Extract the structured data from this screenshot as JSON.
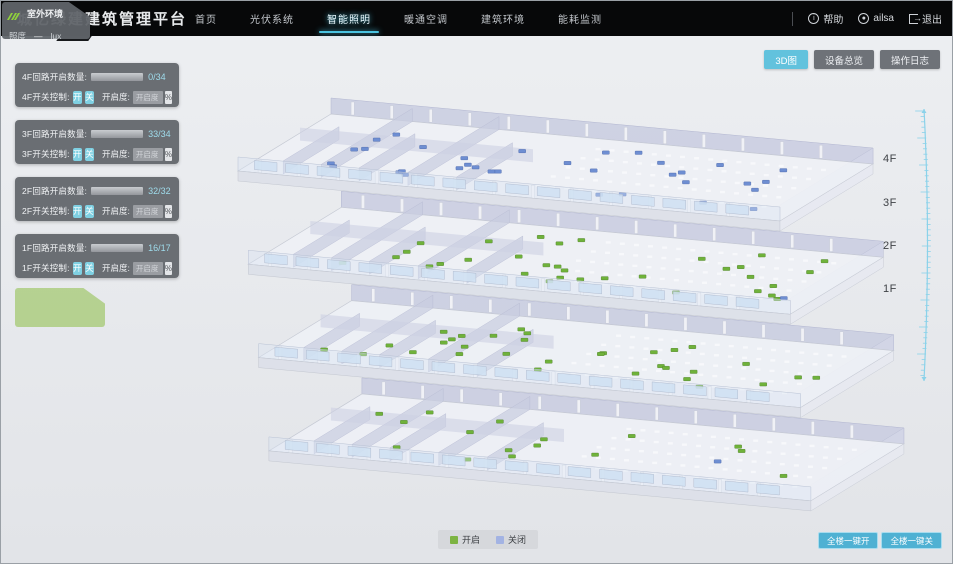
{
  "header": {
    "title": "城亿绿建建筑管理平台",
    "nav": [
      {
        "label": "首页"
      },
      {
        "label": "光伏系统"
      },
      {
        "label": "智能照明"
      },
      {
        "label": "暖通空调"
      },
      {
        "label": "建筑环境"
      },
      {
        "label": "能耗监测"
      }
    ],
    "right": {
      "help": "帮助",
      "user": "ailsa",
      "logout": "退出"
    }
  },
  "floor_panels": [
    {
      "count_label": "4F回路开启数量:",
      "count_text": "0/34",
      "on": 0,
      "total": 34,
      "switch_label": "4F开关控制:",
      "on_btn": "开",
      "off_btn": "关",
      "dim_label": "开启度:",
      "dim_placeholder": "开启度",
      "percent": "%"
    },
    {
      "count_label": "3F回路开启数量:",
      "count_text": "33/34",
      "on": 33,
      "total": 34,
      "switch_label": "3F开关控制:",
      "on_btn": "开",
      "off_btn": "关",
      "dim_label": "开启度:",
      "dim_placeholder": "开启度",
      "percent": "%"
    },
    {
      "count_label": "2F回路开启数量:",
      "count_text": "32/32",
      "on": 32,
      "total": 32,
      "switch_label": "2F开关控制:",
      "on_btn": "开",
      "off_btn": "关",
      "dim_label": "开启度:",
      "dim_placeholder": "开启度",
      "percent": "%"
    },
    {
      "count_label": "1F回路开启数量:",
      "count_text": "16/17",
      "on": 16,
      "total": 17,
      "switch_label": "1F开关控制:",
      "on_btn": "开",
      "off_btn": "关",
      "dim_label": "开启度:",
      "dim_placeholder": "开启度",
      "percent": "%"
    }
  ],
  "outdoor": {
    "title": "室外环境",
    "metric": "照度",
    "value": "—",
    "unit": "lux"
  },
  "view_buttons": [
    {
      "label": "3D图",
      "active": true
    },
    {
      "label": "设备总览",
      "active": false
    },
    {
      "label": "操作日志",
      "active": false
    }
  ],
  "floor_labels": [
    "4F",
    "3F",
    "2F",
    "1F"
  ],
  "legend": [
    {
      "label": "开启",
      "color": "#7cb342"
    },
    {
      "label": "关闭",
      "color": "#a3b3e3"
    }
  ],
  "bulk_buttons": [
    {
      "label": "全楼一键开"
    },
    {
      "label": "全楼一键关"
    }
  ],
  "building": {
    "floors": [
      {
        "name": "4F",
        "lights_on": 0,
        "lights_off": 34
      },
      {
        "name": "3F",
        "lights_on": 33,
        "lights_off": 1
      },
      {
        "name": "2F",
        "lights_on": 32,
        "lights_off": 0
      },
      {
        "name": "1F",
        "lights_on": 16,
        "lights_off": 1
      }
    ],
    "on_color": "#6fb23a",
    "off_color": "#6e8ed2"
  }
}
